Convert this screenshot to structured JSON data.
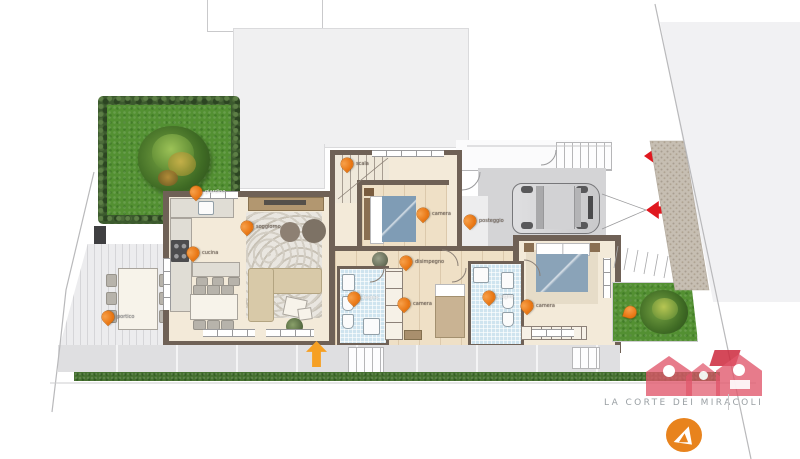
{
  "plan": {
    "description": "floor-plan",
    "pins": [
      {
        "id": "garden-left",
        "label": "giardino"
      },
      {
        "id": "kitchen",
        "label": "cucina"
      },
      {
        "id": "living",
        "label": "soggiorno"
      },
      {
        "id": "stairs",
        "label": "scala"
      },
      {
        "id": "bedroom-1",
        "label": "camera"
      },
      {
        "id": "parking",
        "label": "posteggio"
      },
      {
        "id": "hallway",
        "label": "disimpegno"
      },
      {
        "id": "bathroom-1",
        "label": "bagno"
      },
      {
        "id": "bedroom-2",
        "label": "camera"
      },
      {
        "id": "bathroom-2",
        "label": "bagno"
      },
      {
        "id": "master-bedroom",
        "label": "camera"
      },
      {
        "id": "porch",
        "label": "portico"
      },
      {
        "id": "garden-right",
        "label": ""
      }
    ]
  },
  "watermark": {
    "agency_name": "LA CORTE DEI MIRACOLI"
  },
  "colors": {
    "pin_orange": "#ee7d12",
    "arrow_red": "#e0181f",
    "entrance_arrow_orange": "#f6a024",
    "logo_pink": "#e0566b",
    "logo_orange": "#e8831d",
    "wall_brown": "#6f6156",
    "grass_green": "#539032",
    "bath_tile_blue": "#cfe4ef",
    "parking_grey": "#d4d4d6"
  }
}
